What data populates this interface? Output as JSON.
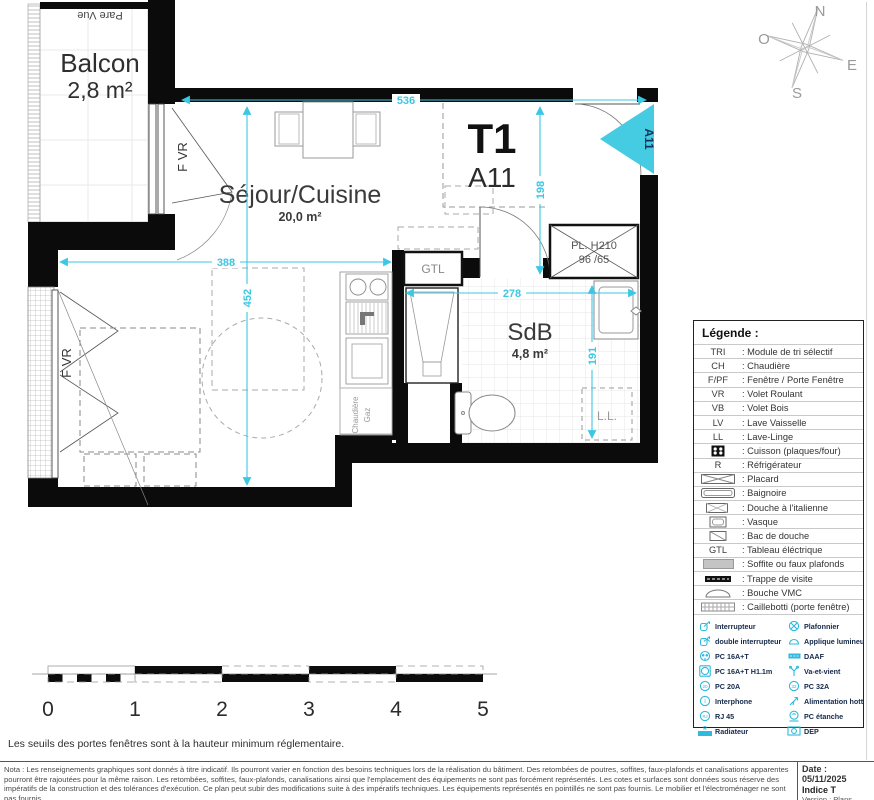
{
  "colors": {
    "walls": "#0b0b0b",
    "dimension": "#3cc7e2",
    "entrance": "#45cce3",
    "electrical": "#2fb9dc"
  },
  "plan": {
    "unit_type": "T1",
    "unit_id": "A11",
    "entrance_tag": "A11",
    "balcony": {
      "name": "Balcon",
      "area": "2,8 m²",
      "pare_vue": "Pare Vue",
      "window": "F VR"
    },
    "living": {
      "name": "Séjour/Cuisine",
      "area": "20,0 m²",
      "window": "F VR"
    },
    "bathroom": {
      "name": "SdB",
      "area": "4,8 m²",
      "washer": "L.L."
    },
    "labels": {
      "gtl": "GTL",
      "placard_line1": "PL. H210",
      "placard_line2": "96 /65",
      "boiler_line1": "Chaudière",
      "boiler_line2": "Gaz"
    },
    "dimensions": {
      "top": "536",
      "hall_h": "198",
      "living_w": "388",
      "living_h": "452",
      "bath_w": "278",
      "bath_h": "191"
    },
    "compass": {
      "n": "N",
      "s": "S",
      "e": "E",
      "o": "O"
    }
  },
  "legend": {
    "title": "Légende :",
    "rows": [
      {
        "key": "TRI",
        "label": ": Module de tri sélectif"
      },
      {
        "key": "CH",
        "label": ": Chaudière"
      },
      {
        "key": "F/PF",
        "label": ": Fenêtre / Porte Fenêtre"
      },
      {
        "key": "VR",
        "label": ": Volet Roulant"
      },
      {
        "key": "VB",
        "label": ": Volet Bois"
      },
      {
        "key": "LV",
        "label": ": Lave Vaisselle"
      },
      {
        "key": "LL",
        "label": ": Lave-Linge"
      },
      {
        "icon": "cuisson-icon",
        "label": ": Cuisson (plaques/four)"
      },
      {
        "key": "R",
        "label": ": Réfrigérateur"
      },
      {
        "icon": "placard-icon",
        "label": ": Placard"
      },
      {
        "icon": "baignoire-icon",
        "label": ": Baignoire"
      },
      {
        "icon": "douche-italienne-icon",
        "label": ": Douche à l'italienne"
      },
      {
        "icon": "vasque-icon",
        "label": ": Vasque"
      },
      {
        "icon": "bac-douche-icon",
        "label": ": Bac de douche"
      },
      {
        "key": "GTL",
        "label": ": Tableau éléctrique"
      },
      {
        "icon": "soffite-icon",
        "label": ": Soffite ou faux plafonds"
      },
      {
        "icon": "trappe-icon",
        "label": ": Trappe de visite"
      },
      {
        "icon": "vmc-icon",
        "label": ": Bouche VMC"
      },
      {
        "icon": "caillebotti-icon",
        "label": ": Caillebotti (porte fenêtre)"
      }
    ],
    "electrical": {
      "left": [
        {
          "icon": "switch-icon",
          "label": "Interrupteur"
        },
        {
          "icon": "double-switch-icon",
          "label": "double interrupteur"
        },
        {
          "icon": "pc16-icon",
          "label": "PC 16A+T"
        },
        {
          "icon": "pc16h-icon",
          "label": "PC 16A+T H1.1m"
        },
        {
          "icon": "pc20-icon",
          "label": "PC 20A"
        },
        {
          "icon": "interphone-icon",
          "label": "Interphone"
        },
        {
          "icon": "rj45-icon",
          "label": "RJ 45"
        },
        {
          "icon": "radiateur-icon",
          "label": "Radiateur"
        }
      ],
      "right": [
        {
          "icon": "plafonnier-icon",
          "label": "Plafonnier"
        },
        {
          "icon": "applique-icon",
          "label": "Applique lumineuse"
        },
        {
          "icon": "daaf-icon",
          "label": "DAAF"
        },
        {
          "icon": "vaetvient-icon",
          "label": "Va-et-vient"
        },
        {
          "icon": "pc32-icon",
          "label": "PC 32A"
        },
        {
          "icon": "hotte-icon",
          "label": "Alimentation hotte"
        },
        {
          "icon": "pc-etanche-icon",
          "label": "PC étanche"
        },
        {
          "icon": "dep-icon",
          "label": "DEP"
        }
      ]
    }
  },
  "scalebar": {
    "ticks": [
      "0",
      "1",
      "2",
      "3",
      "4",
      "5"
    ]
  },
  "notes": {
    "threshold": "Les seuils des portes fenêtres sont à la hauteur minimum réglementaire.",
    "nota": "Nota : Les renseignements graphiques sont donnés à titre indicatif. Ils pourront varier en fonction des besoins techniques lors de la réalisation du bâtiment. Des retombées de poutres, soffites, faux-plafonds et canalisations apparentes pourront être rajoutées pour la même raison.  Les retombées, soffites, faux-plafonds, canalisations ainsi que l'emplacement des équipements ne sont pas forcément représentés. Les cotes et surfaces sont données sous réserve des impératifs de la construction et des tolérances d'exécution. Ce plan peut subir des modifications suite à des impératifs techniques.  Les équipements représentés en pointillés ne sont pas fournis. Le mobilier et l'électroménager ne sont pas fournis."
  },
  "titleblock": {
    "date": "Date : 05/11/2025",
    "indice": "Indice T",
    "version_line1": "Version : Plans",
    "version_line2": "provisoires"
  }
}
